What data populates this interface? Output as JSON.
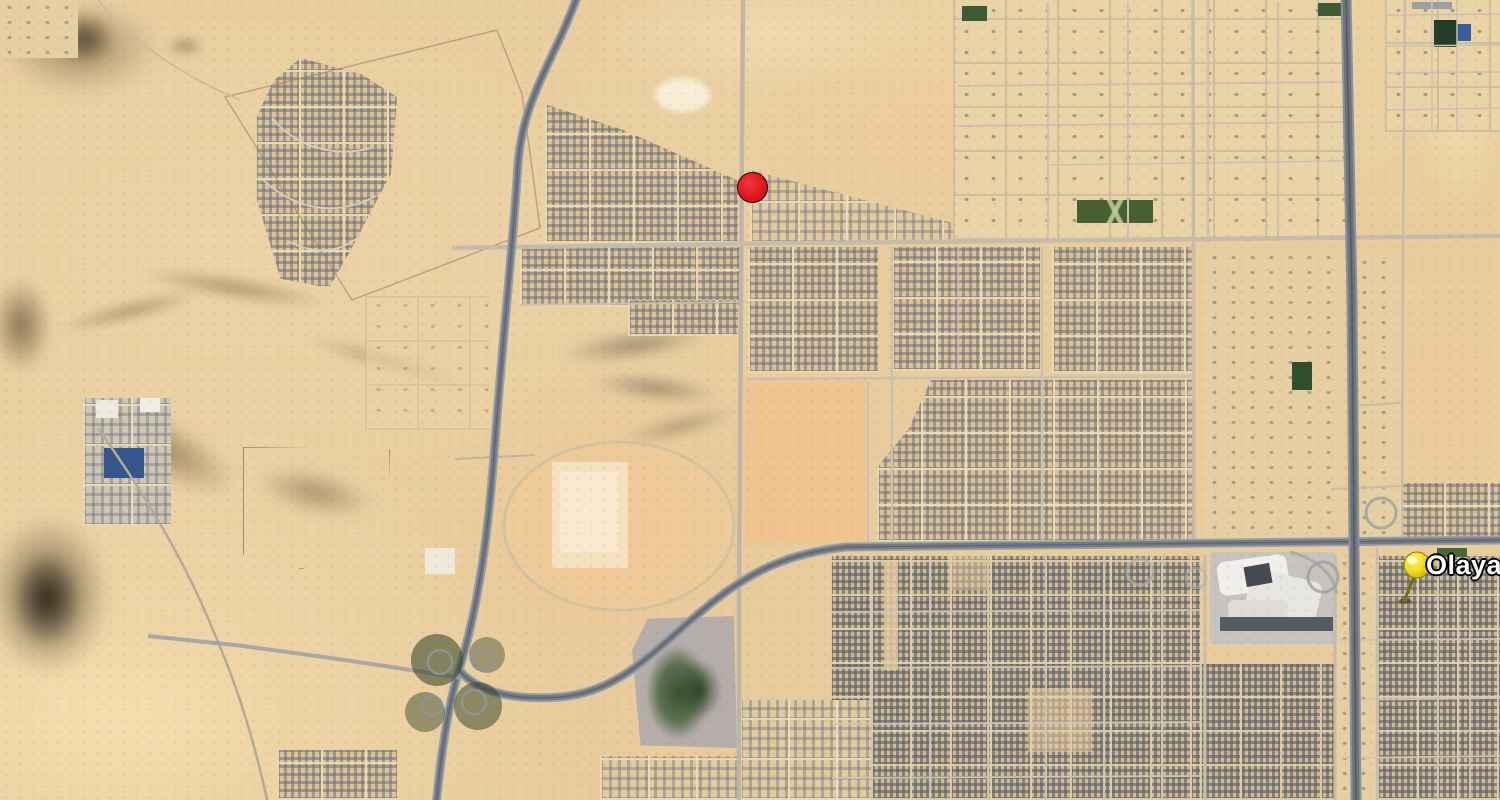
{
  "map": {
    "view_type": "satellite-imagery",
    "markers": {
      "olaya": {
        "label": "Olaya",
        "icon": "yellow-pushpin-icon",
        "pin_color": "#efdf1e",
        "label_color": "#ffffff",
        "label_outline_color": "#000000"
      },
      "poi": {
        "label": "",
        "icon": "red-dot-icon",
        "color": "#e01219",
        "border_color": "#1d0505"
      }
    },
    "palette": {
      "desert_base": "#e8cc9e",
      "desert_pink": "#f3c294",
      "desert_light": "#f7e2b2",
      "rock_dark": "#2a2314",
      "urban_block_gray": "#68707e",
      "urban_ground_tan": "#dcc296",
      "road_minor": "#c9bfae",
      "road_highway": "#757b84",
      "vegetation_green": "#3f5a33"
    }
  }
}
